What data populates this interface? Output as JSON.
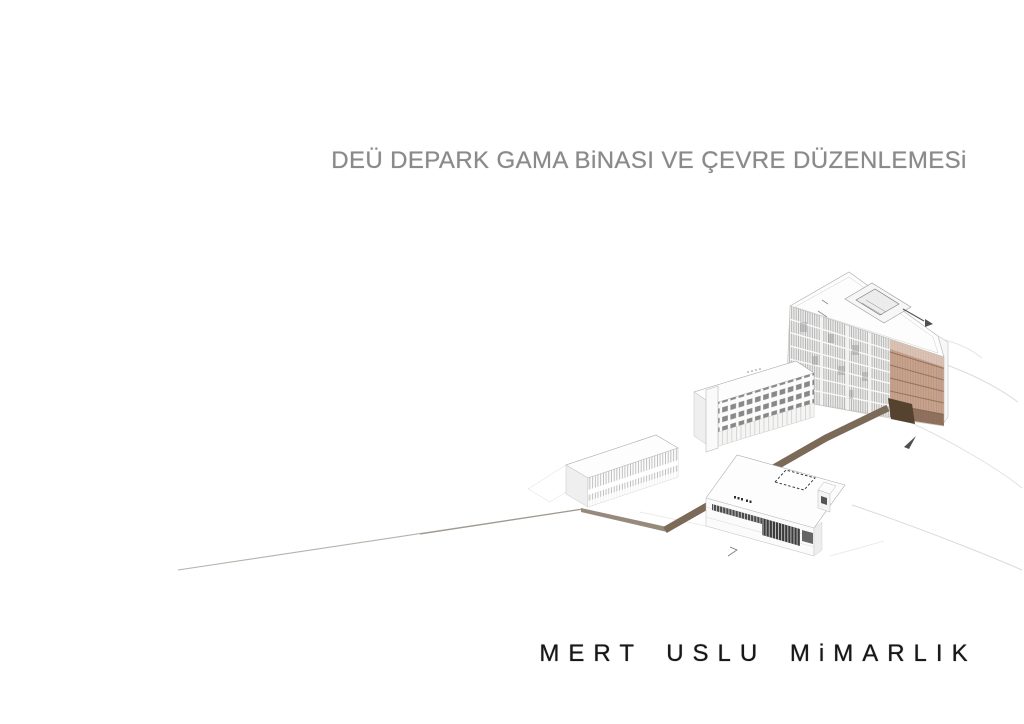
{
  "page": {
    "title": "DEÜ DEPARK GAMA BiNASI VE ÇEVRE DÜZENLEMESi",
    "brand": "MERT USLU MiMARLIK",
    "illustration_alt": "Axonometric site rendering: large louvered block with tan end facade, three smaller white buildings and a brown pedestrian walkway crossing the site"
  },
  "colors": {
    "bg-color": "#ffffff",
    "title-color": "#8a8a8a",
    "brand-color": "#171717",
    "walkway-color": "#7b6a58",
    "walkway-light-color": "#978a7c",
    "road-line-color": "#b7b1ab",
    "entrance-color": "#55422f",
    "tan-color": "#c7a28d",
    "tan-line-color": "#96735e",
    "tan-dark-color": "#7c604d",
    "louver-color": "#a3a3a3",
    "facade-color": "#ececeb",
    "window-color": "#757575",
    "glazing-color": "#3b3b3b",
    "outline-color": "#ababab",
    "outline-light-color": "#cfcfcf",
    "contour-color": "#dedad5",
    "mark-color": "#4f4f4f",
    "roof-color": "#fdfdfd"
  }
}
